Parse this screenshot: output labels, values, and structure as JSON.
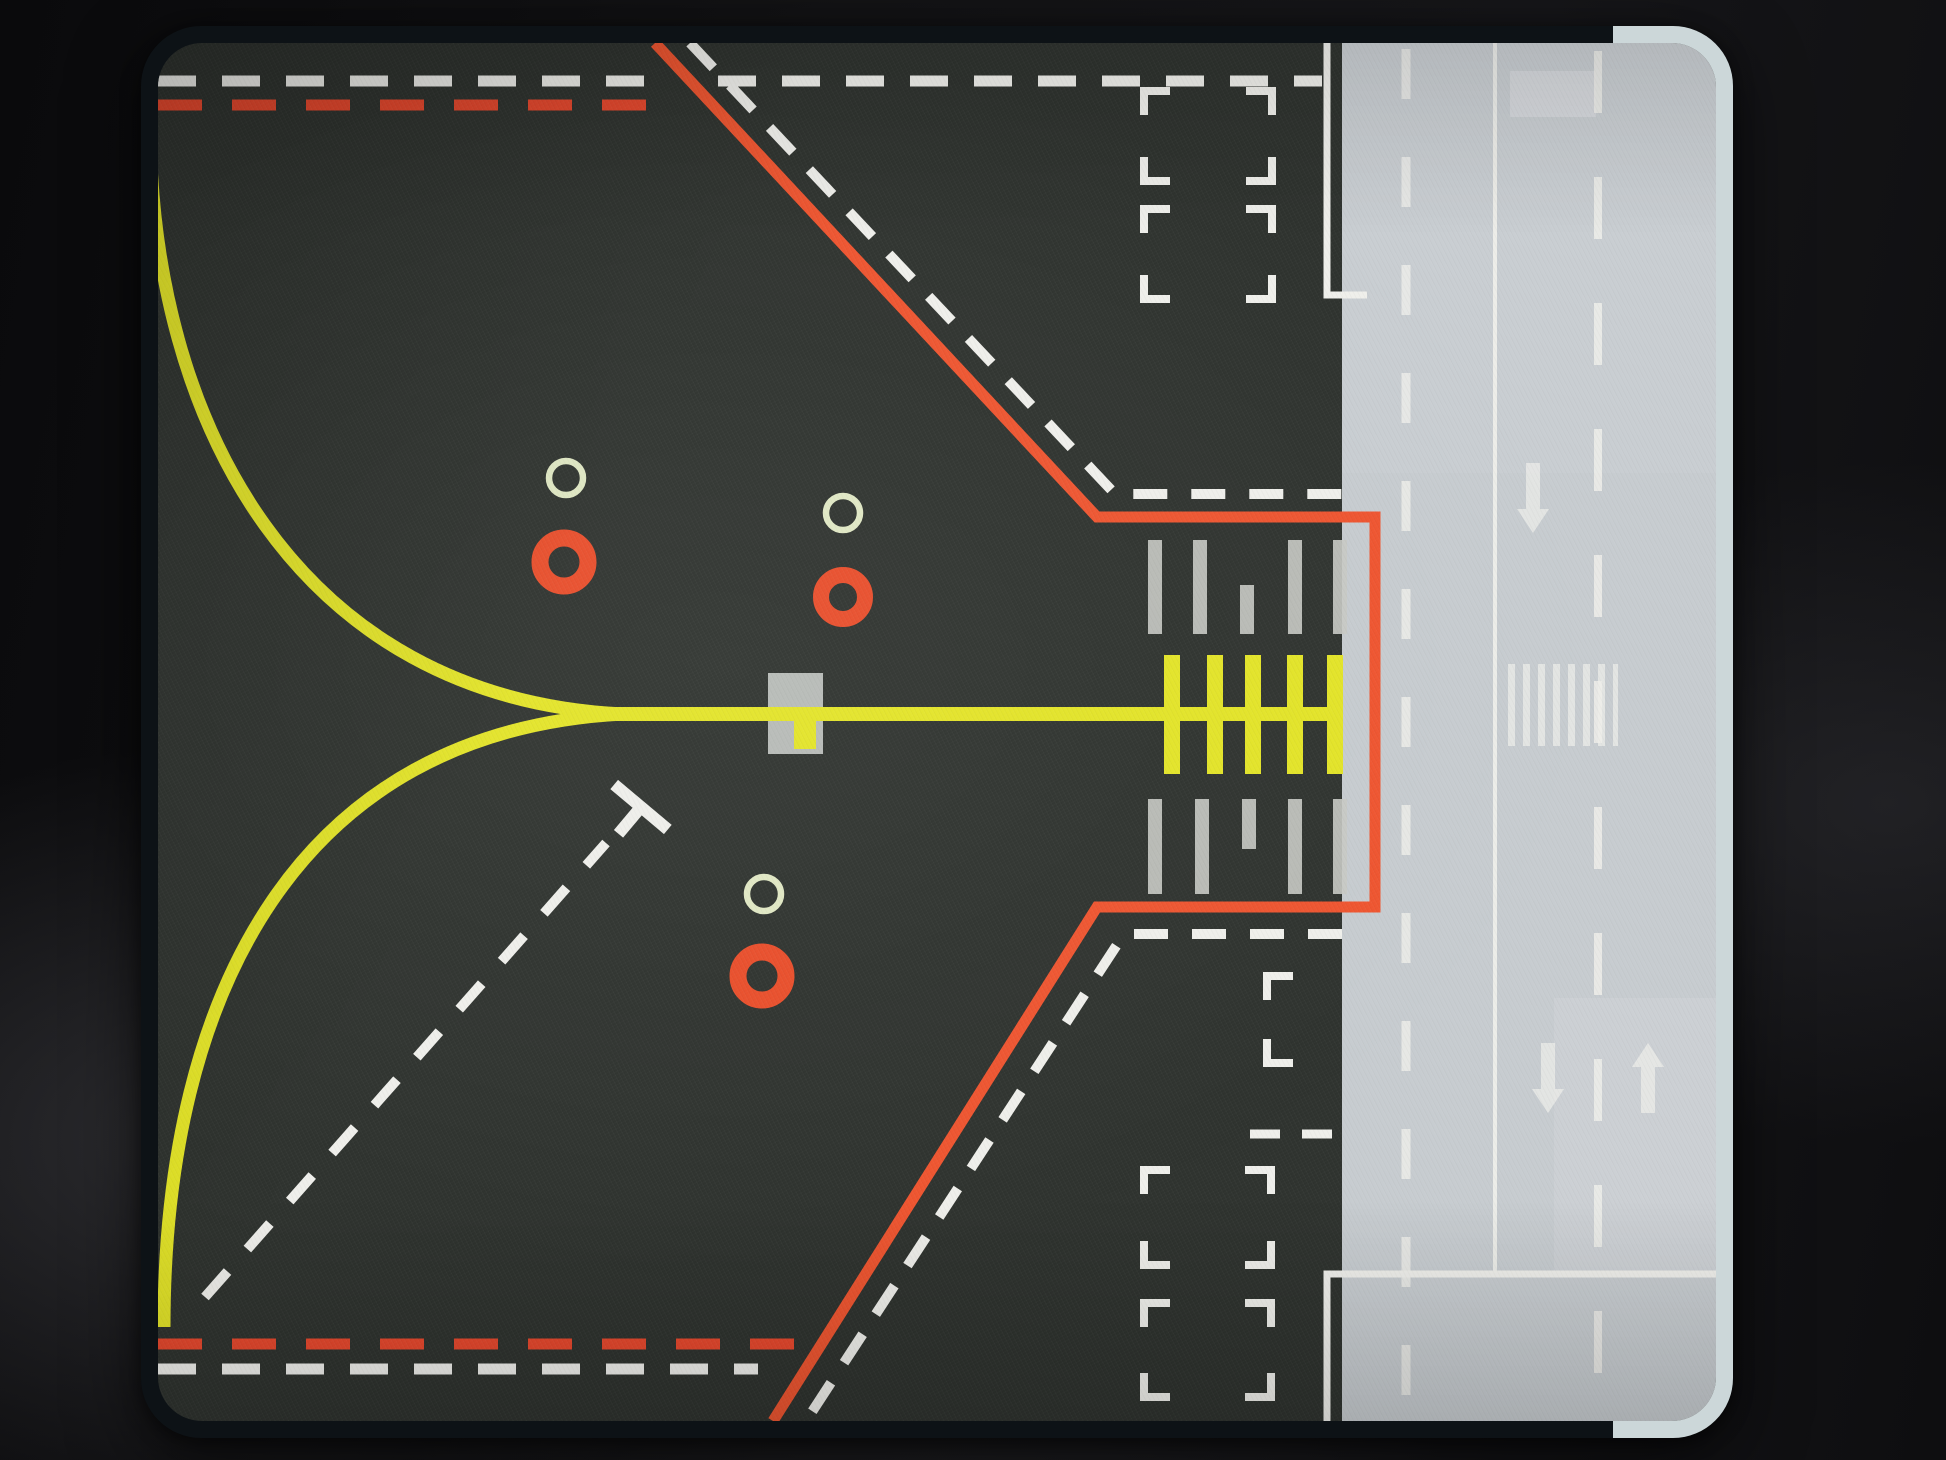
{
  "colors": {
    "background": "#111113",
    "pad_edge_dark": "#0d1216",
    "pad_edge_light": "#ccd7d9",
    "pad_fabric": "#2f332f",
    "runway_gray": "#c7ccd0",
    "taxiway_yellow": "#e3e428",
    "hold_orange": "#ee5530",
    "dashed_red": "#e6482d",
    "marking_white": "#efefeb",
    "hold_bar_gray": "#c9cac5",
    "ring_pale": "#e0e8c4",
    "ring_orange": "#e94e2b",
    "square_gray": "#b7bbb7"
  },
  "markings": {
    "enhanced_centerline_bar_count": 5,
    "hold_position_bar_rows": 2,
    "position_ring_count": 6,
    "corner_bracket_rectangles": 5,
    "runway_arrow_count": 3
  }
}
